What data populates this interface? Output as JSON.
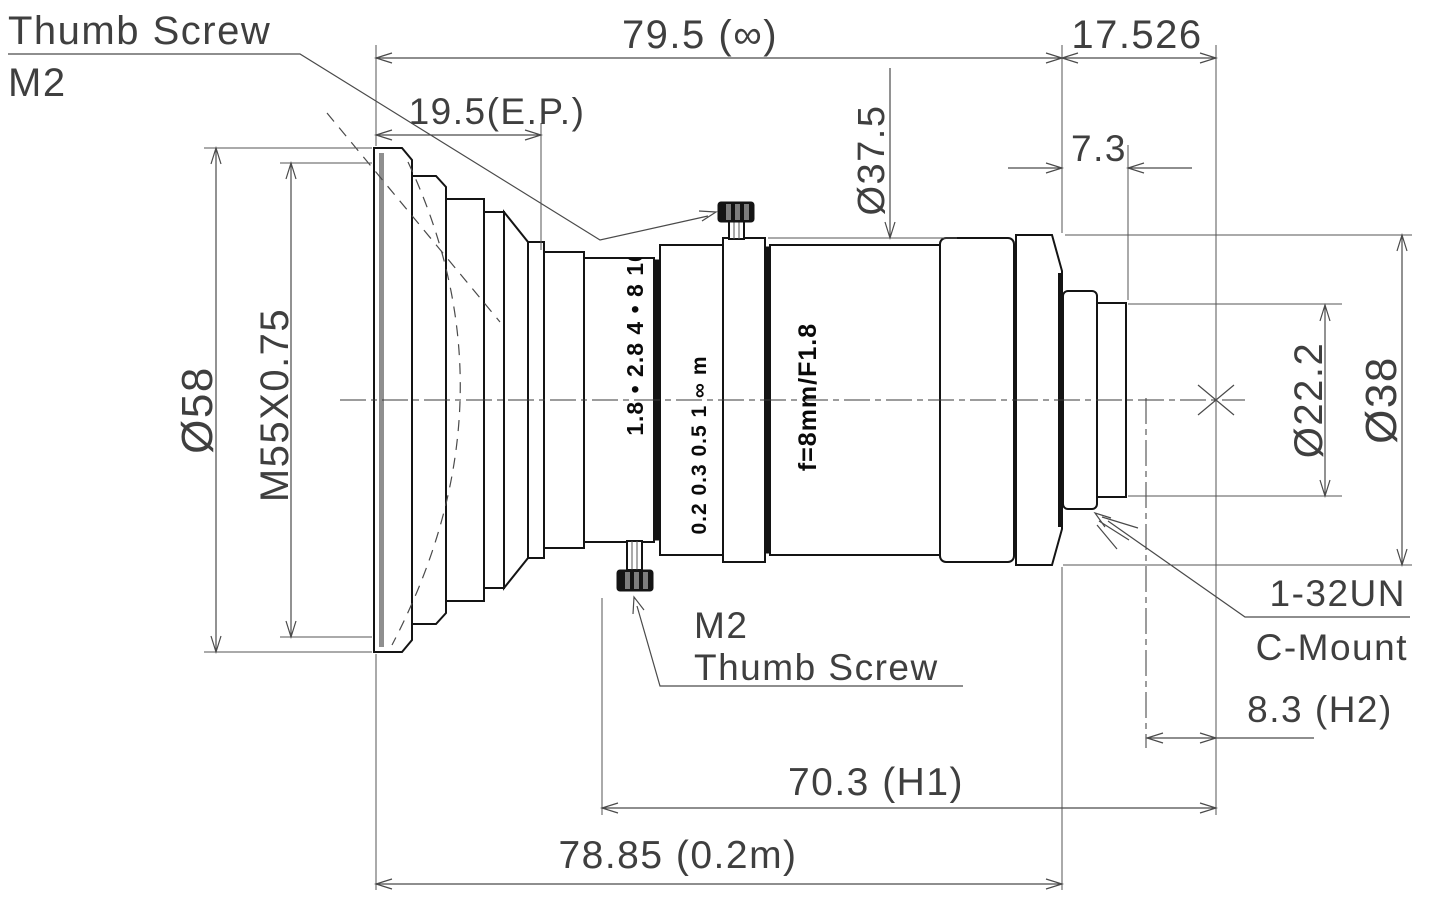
{
  "drawing": {
    "callouts": {
      "thumb_screw_top_line1": "Thumb Screw",
      "thumb_screw_top_line2": "M2",
      "thumb_screw_bottom_line1": "M2",
      "thumb_screw_bottom_line2": "Thumb Screw",
      "mount_thread": "1-32UN",
      "mount_type": "C-Mount"
    },
    "dimensions": {
      "overall_length_infinity": "79.5 (∞)",
      "flange_focal_distance": "17.526",
      "entrance_pupil": "19.5(E.P.)",
      "rear_protrusion": "7.3",
      "barrel_diameter": "Ø37.5",
      "front_diameter": "Ø58",
      "filter_thread": "M55X0.75",
      "mount_stub_diameter": "Ø22.2",
      "rear_diameter": "Ø38",
      "h2_distance": "8.3 (H2)",
      "h1_distance": "70.3 (H1)",
      "overall_length_near": "78.85 (0.2m)"
    },
    "barrel_markings": {
      "aperture_scale": "1.8 • 2.8 4 • 8 16",
      "focus_scale": "0.2 0.3 0.5 1 ∞ m",
      "lens_spec": "f=8mm/F1.8"
    },
    "colors": {
      "ink": "#141414",
      "dimension": "#454545",
      "background": "#ffffff"
    }
  }
}
